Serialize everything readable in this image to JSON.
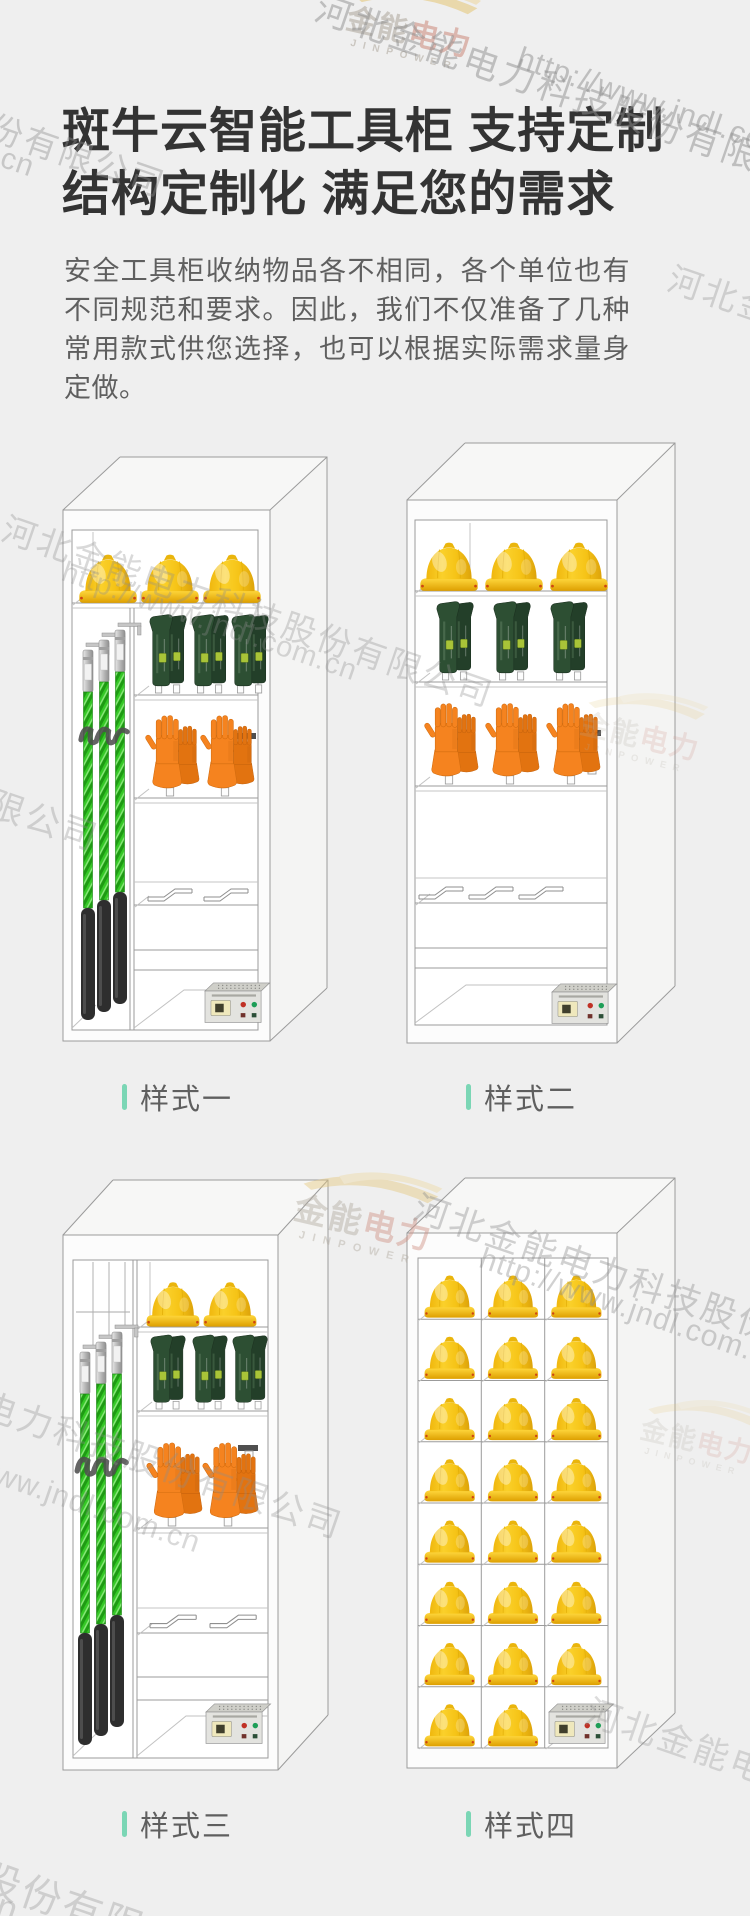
{
  "page": {
    "background": "#efefef"
  },
  "header": {
    "title_line1": "斑牛云智能工具柜 支持定制",
    "title_line2": "结构定制化 满足您的需求",
    "description": "安全工具柜收纳物品各不相同，各个单位也有不同规范和要求。因此，我们不仅准备了几种常用款式供您选择，也可以根据实际需求量身定做。"
  },
  "watermark": {
    "company": "河北金能电力科技股份有限公司",
    "url": "http://www.jndl.com.cn",
    "logo_text_primary": "金能",
    "logo_text_secondary": "电力",
    "logo_subtext": "JINPOWER"
  },
  "accent_color": "#7bd6b5",
  "cabinets": [
    {
      "label": "样式一",
      "layout": "pole-side",
      "helmets": 3,
      "boot_pairs": 3,
      "glove_pairs": 2,
      "poles": 3,
      "hanger_brackets": 2,
      "has_controller": true
    },
    {
      "label": "样式二",
      "layout": "shelves",
      "helmets": 3,
      "boot_pairs": 3,
      "glove_pairs": 3,
      "poles": 0,
      "hanger_brackets": 3,
      "has_controller": true
    },
    {
      "label": "样式三",
      "layout": "pole-side",
      "helmets": 2,
      "boot_pairs": 3,
      "glove_pairs": 2,
      "poles": 3,
      "hanger_brackets": 2,
      "has_controller": true
    },
    {
      "label": "样式四",
      "layout": "grid",
      "grid_rows": 8,
      "grid_cols": 3,
      "helmets": 23,
      "has_controller": true
    }
  ],
  "colors": {
    "helmet_yellow": "#f6c417",
    "glove_orange": "#f5831f",
    "boot_green": "#2d4f33",
    "pole_green": "#35c826",
    "cabinet_line": "#9b9b9b",
    "title_text": "#333333",
    "body_text": "#5f5f5f",
    "label_text": "#5f5f5f"
  }
}
